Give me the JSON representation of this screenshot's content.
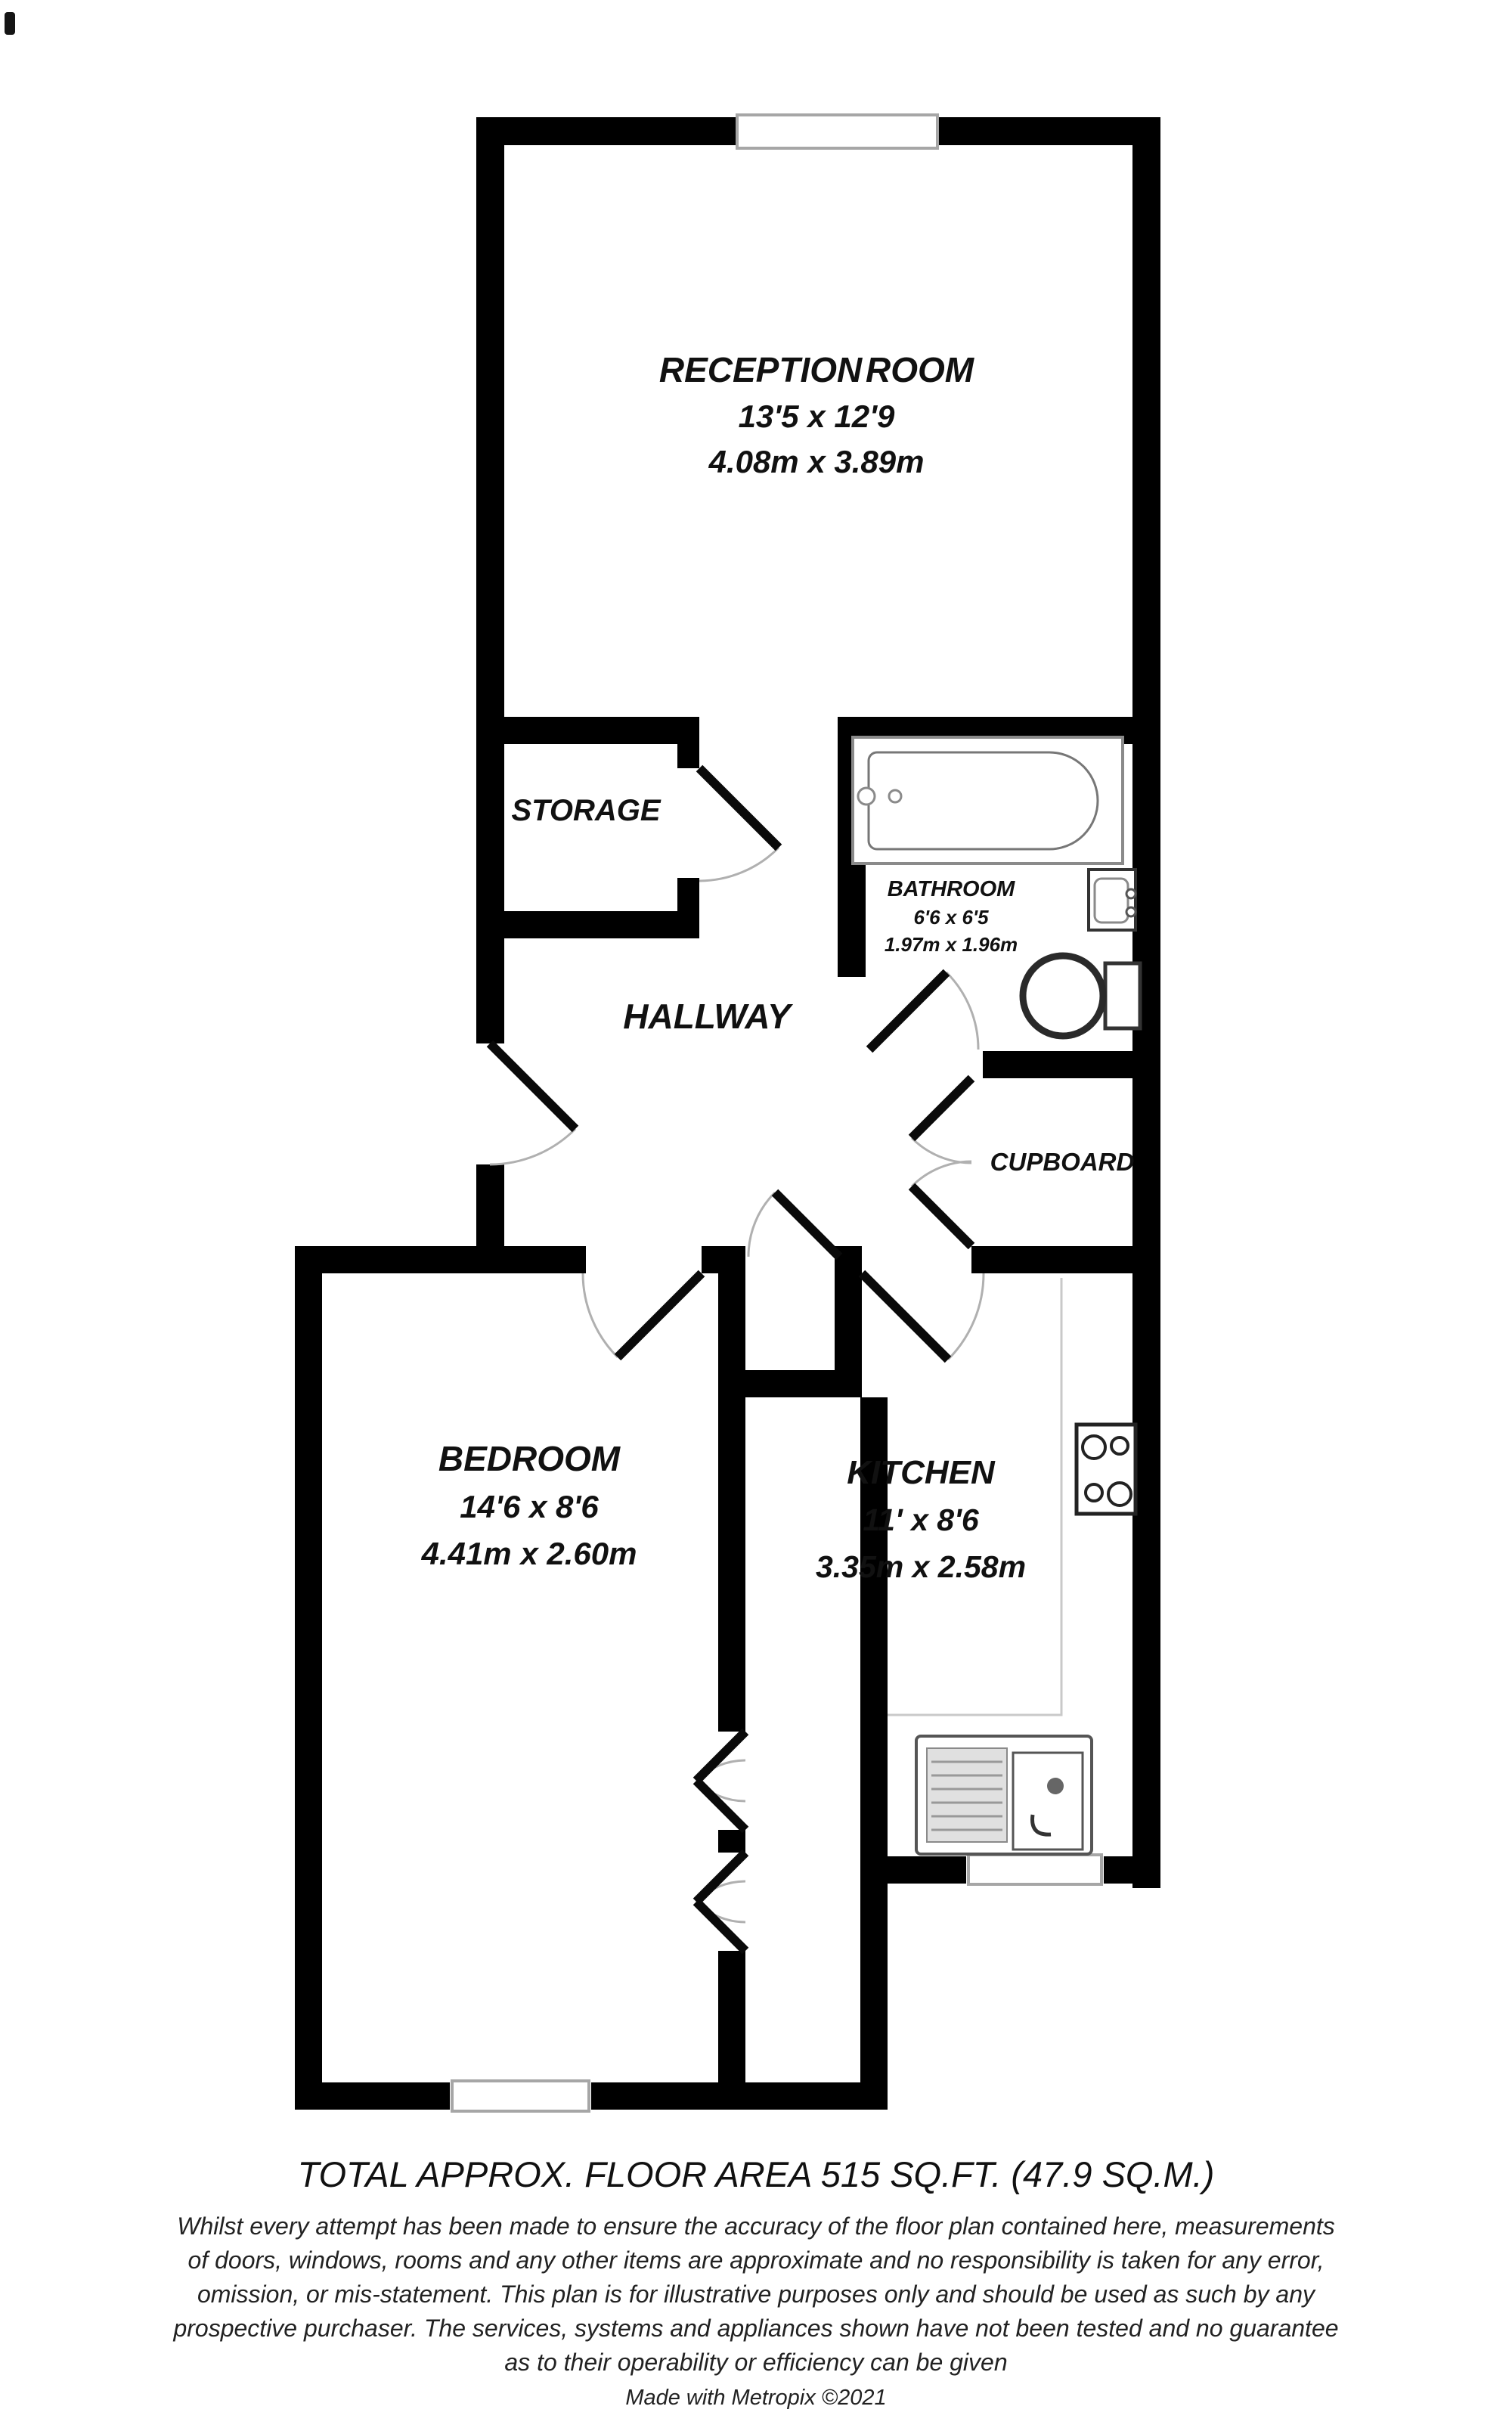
{
  "title": "Flat floor plan",
  "colors": {
    "wall": "#000000",
    "door_leaf": "#0a0a0a",
    "door_arc": "#b0b0b0",
    "fixture_dark": "#333333",
    "fixture_gray": "#8a8a8a",
    "window_frame": "#a6a6a6",
    "counter_line": "#c9c9c9",
    "text": "#111111"
  },
  "rooms": {
    "reception": {
      "name": "RECEPTION ROOM",
      "imperial": "13'5 x 12'9",
      "metric": "4.08m x 3.89m"
    },
    "storage": {
      "name": "STORAGE"
    },
    "bathroom": {
      "name": "BATHROOM",
      "imperial": "6'6 x 6'5",
      "metric": "1.97m x 1.96m"
    },
    "hallway": {
      "name": "HALLWAY"
    },
    "cupboard": {
      "name": "CUPBOARD"
    },
    "bedroom": {
      "name": "BEDROOM",
      "imperial": "14'6 x 8'6",
      "metric": "4.41m x 2.60m"
    },
    "kitchen": {
      "name": "KITCHEN",
      "imperial": "11' x 8'6",
      "metric": "3.35m x 2.58m"
    }
  },
  "fixtures": {
    "bathtub": "bathtub",
    "basin": "wash basin",
    "toilet": "toilet",
    "hob": "4-ring hob",
    "kitchen_sink": "sink and drainer",
    "window_count": 3
  },
  "footer": {
    "total_area": "TOTAL APPROX. FLOOR AREA 515 SQ.FT. (47.9 SQ.M.)",
    "disclaimer_lines": [
      "Whilst every attempt has been made to ensure the accuracy of the floor plan contained here, measurements",
      "of doors, windows, rooms and any other items are approximate and no responsibility is taken for any error,",
      "omission, or mis-statement. This plan is for illustrative purposes only and should be used as such by any",
      "prospective purchaser. The services, systems and appliances shown have not been tested and no guarantee",
      "as to their operability or efficiency can be given"
    ],
    "credit": "Made with Metropix ©2021"
  }
}
